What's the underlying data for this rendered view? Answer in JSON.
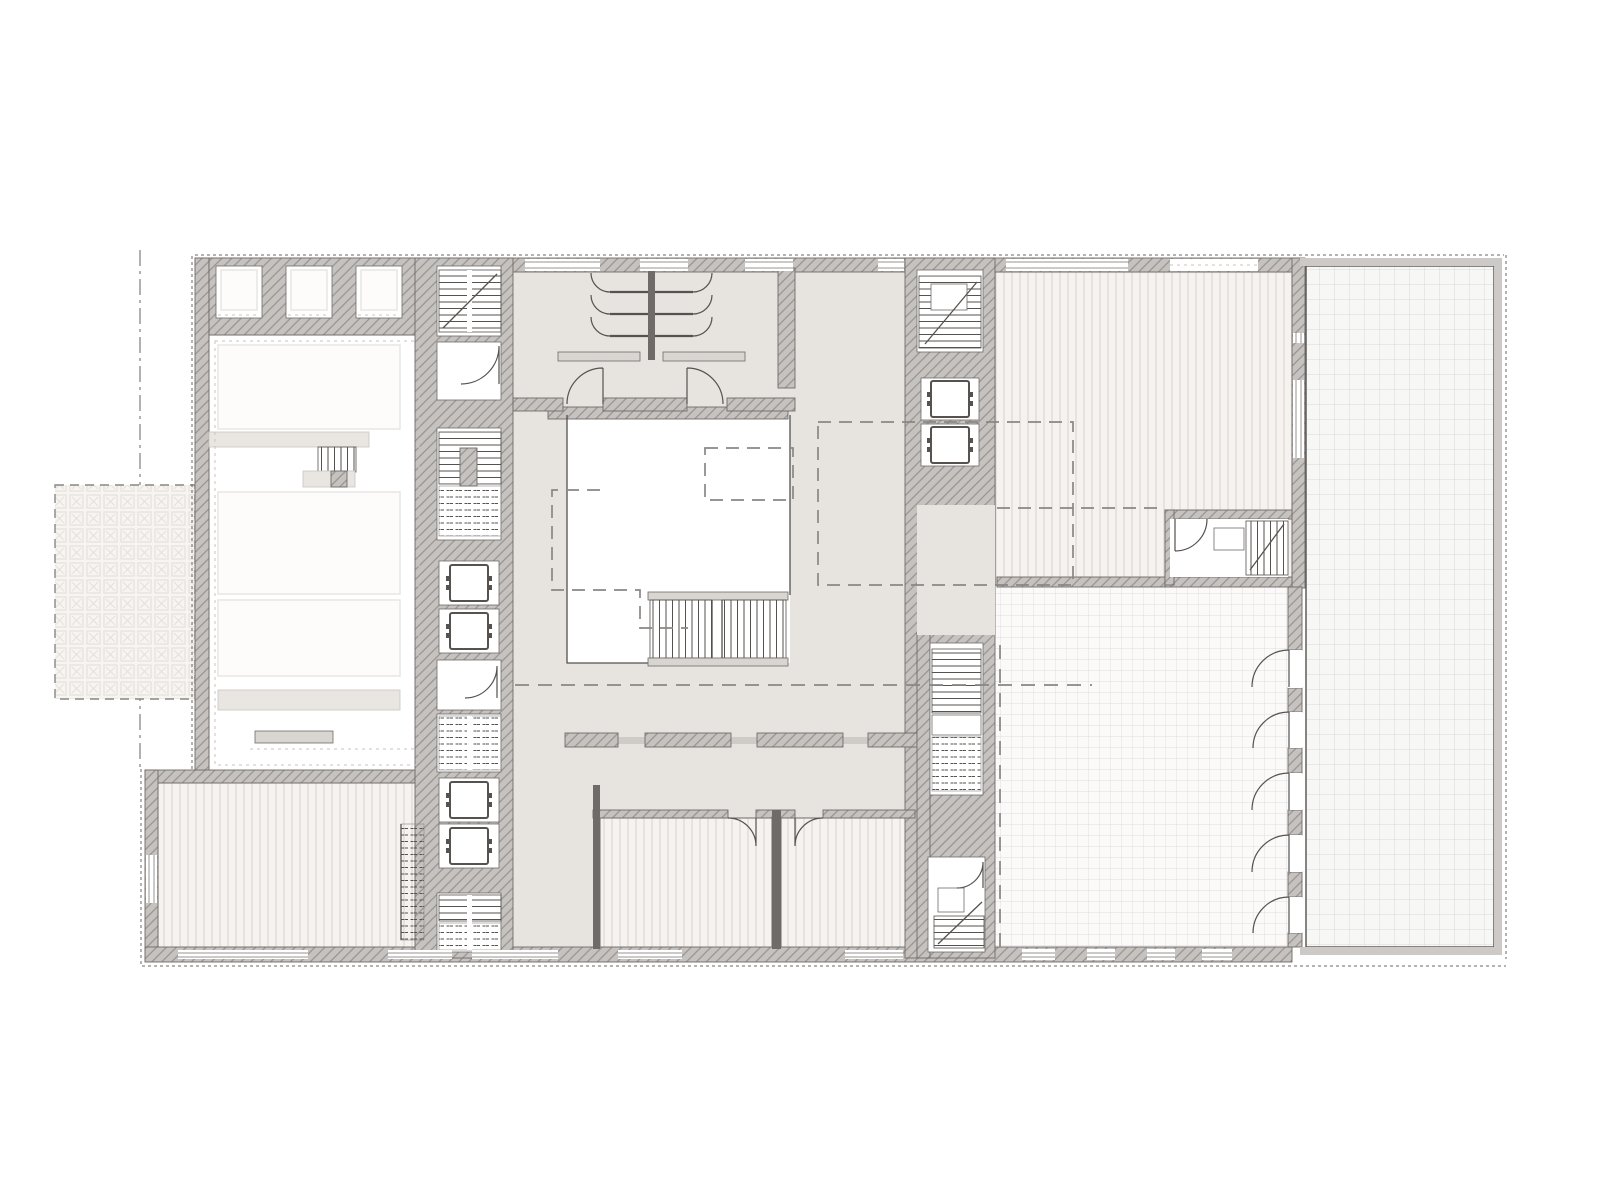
{
  "plan": {
    "kind": "architectural-floor-plan",
    "visible_text": ""
  },
  "colors": {
    "paper": "#ffffff",
    "white": "#ffffff",
    "floorGray": "#e7e4e0",
    "bandGray": "#cfccc8",
    "wallFill": "#c6c2bf",
    "wallLine": "#96928f",
    "borderSolid": "#cdc9c6",
    "outline": "#6f6b68",
    "dark": "#55524f",
    "stripeBg": "#f5f2ef",
    "stripeLine": "#d8d3ce",
    "gridBg": "#fbfaf9",
    "gridLine": "#dcdce3",
    "terraceBg": "#f7f7f5",
    "terraceLine": "#d9d9e1",
    "xBg": "#f7f4f1",
    "xLine": "#e6e1db",
    "barFill": "#d9d5d1",
    "barLight": "#e9e6e1",
    "faintFill": "#fdfcfb",
    "faintLine": "#e9e6e1",
    "dashColor": "#8a8683"
  }
}
